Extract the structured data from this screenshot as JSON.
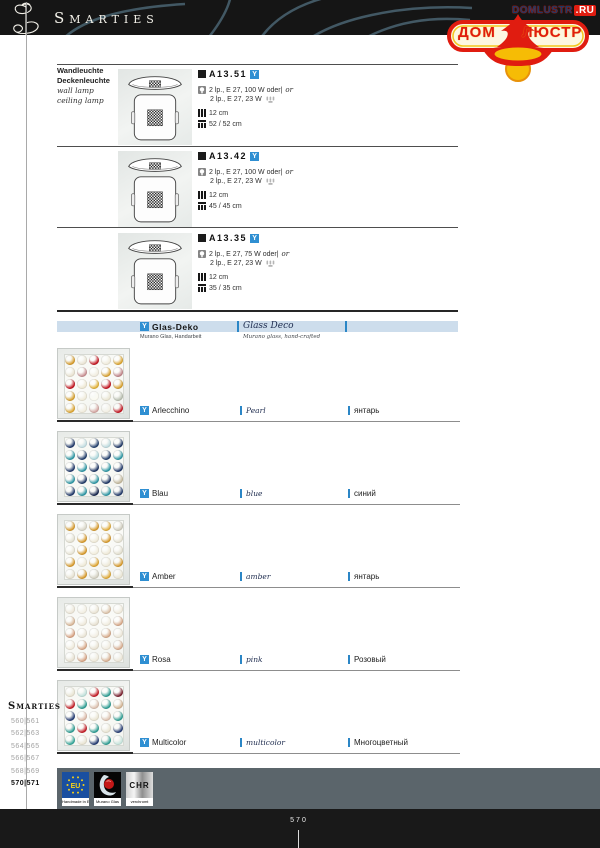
{
  "header": {
    "title": "Smarties"
  },
  "watermark": {
    "url_text": "DOMLUSTR",
    "url_suffix": ".RU",
    "word_left": "ДОМ",
    "word_right": "ЛЮСТР"
  },
  "category": {
    "de_line1": "Wandleuchte",
    "de_line2": "Deckenleuchte",
    "en_line1": "wall lamp",
    "en_line2": "ceiling lamp"
  },
  "products": [
    {
      "code": "A13.51",
      "badge": "Y",
      "lamp_line1": "2 lp., E 27, 100 W oder|",
      "lamp_or": "or",
      "lamp_line2": "2 lp., E 27, 23 W",
      "height": "12 cm",
      "size": "52 / 52 cm"
    },
    {
      "code": "A13.42",
      "badge": "Y",
      "lamp_line1": "2 lp., E 27, 100 W oder|",
      "lamp_or": "or",
      "lamp_line2": "2 lp., E 27, 23 W",
      "height": "12 cm",
      "size": "45 / 45 cm"
    },
    {
      "code": "A13.35",
      "badge": "Y",
      "lamp_line1": "2 lp., E 27, 75 W oder|",
      "lamp_or": "or",
      "lamp_line2": "2 lp., E 27, 23 W",
      "height": "12 cm",
      "size": "35 / 35 cm"
    }
  ],
  "glass_section": {
    "badge": "Y",
    "title_de": "Glas-Deko",
    "sub_de": "Murano Glas, Handarbeit",
    "title_en": "Glass Deco",
    "sub_en": "Murano glass, hand-crafted"
  },
  "swatches": [
    {
      "badge": "Y",
      "name": "Arlecchino",
      "en": "Pearl",
      "ru": "янтарь",
      "dots": [
        "#d79b2a",
        "#e9e3d2",
        "#c41420",
        "#efead9",
        "#dca42e",
        "#e8e1cf",
        "#c98f92",
        "#f0ebdd",
        "#d9a232",
        "#c2858a",
        "#c41420",
        "#eee7d1",
        "#e2b135",
        "#c41420",
        "#d9a02c",
        "#d8a02c",
        "#efead8",
        "#fbfaf0",
        "#e9e4d0",
        "#b9bfb0",
        "#dda52f",
        "#f1ecdc",
        "#d5a6a2",
        "#f3efe3",
        "#c41420"
      ]
    },
    {
      "badge": "Y",
      "name": "Blau",
      "en": "blue",
      "ru": "синий",
      "dots": [
        "#20386a",
        "#c2dde2",
        "#24406e",
        "#bcdade",
        "#1f3766",
        "#2d97a5",
        "#223e6c",
        "#aad5db",
        "#223e6c",
        "#2d97a5",
        "#20386a",
        "#2d97a5",
        "#1d3564",
        "#2d97a5",
        "#20386a",
        "#2d97a5",
        "#203a68",
        "#2d97a5",
        "#1d3564",
        "#c3b89c",
        "#20386a",
        "#2d97a5",
        "#16254d",
        "#2d97a5",
        "#20386a"
      ]
    },
    {
      "badge": "Y",
      "name": "Amber",
      "en": "amber",
      "ru": "янтарь",
      "dots": [
        "#d89a2b",
        "#d8d5c6",
        "#d89a2b",
        "#e2ac38",
        "#cfccbd",
        "#e2dfd0",
        "#d89a2b",
        "#eee8d5",
        "#d89a2b",
        "#e5e1d1",
        "#e7e3d3",
        "#d89a2b",
        "#f2eddc",
        "#eee8d5",
        "#e2decd",
        "#d89a2b",
        "#eee9d6",
        "#dfa42f",
        "#ede7d4",
        "#d89a2b",
        "#e5e0cf",
        "#d89a2b",
        "#d3d0c1",
        "#e0a935",
        "#e9e4d2"
      ]
    },
    {
      "badge": "Y",
      "name": "Rosa",
      "en": "pink",
      "ru": "Розовый",
      "dots": [
        "#ece5d6",
        "#f2eee1",
        "#e9e2d2",
        "#dcc2a8",
        "#efe9da",
        "#d9b696",
        "#eee8d9",
        "#e6dfcf",
        "#f0ebdd",
        "#d8a888",
        "#d8a282",
        "#e9e3d4",
        "#f1ece0",
        "#d8ab8c",
        "#ece6d7",
        "#efe9da",
        "#d8a888",
        "#e8e1d1",
        "#f0eadd",
        "#d9ad90",
        "#e6dfcf",
        "#d8a485",
        "#eee8d9",
        "#d9b092",
        "#ece5d6"
      ]
    },
    {
      "badge": "Y",
      "name": "Multicolor",
      "en": "multicolor",
      "ru": "Многоцветный",
      "dots": [
        "#e8e3d1",
        "#bfe0da",
        "#c41c26",
        "#2e9e94",
        "#7a1f2e",
        "#c41c26",
        "#2e9e94",
        "#dcc0ae",
        "#2e9e94",
        "#d3b493",
        "#233a72",
        "#dcb8a6",
        "#e9e4d2",
        "#ddc2b0",
        "#2e9e94",
        "#2e9e94",
        "#c41c26",
        "#2e9e94",
        "#e9e4d2",
        "#233a72",
        "#35a79a",
        "#e9e4d2",
        "#233a72",
        "#2e9e94",
        "#c5e4dc"
      ]
    }
  ],
  "footer": {
    "index_title": "Smarties",
    "pages": [
      "560|561",
      "562|563",
      "564|565",
      "566|567",
      "568|569",
      "570|571"
    ],
    "certs": {
      "eu_letters": "EU",
      "eu_label": "Handmade in EU",
      "murano_label": "Murano Glas",
      "chrome_letters": "CHR",
      "chrome_label": "verchromt"
    },
    "page_number": "570"
  },
  "colors": {
    "badge_blue": "#2f8fd2",
    "band_blue": "#cdddec",
    "watermark_red": "#e01c10",
    "watermark_yellow": "#f6bc05",
    "footer_slate": "#5b656b"
  }
}
